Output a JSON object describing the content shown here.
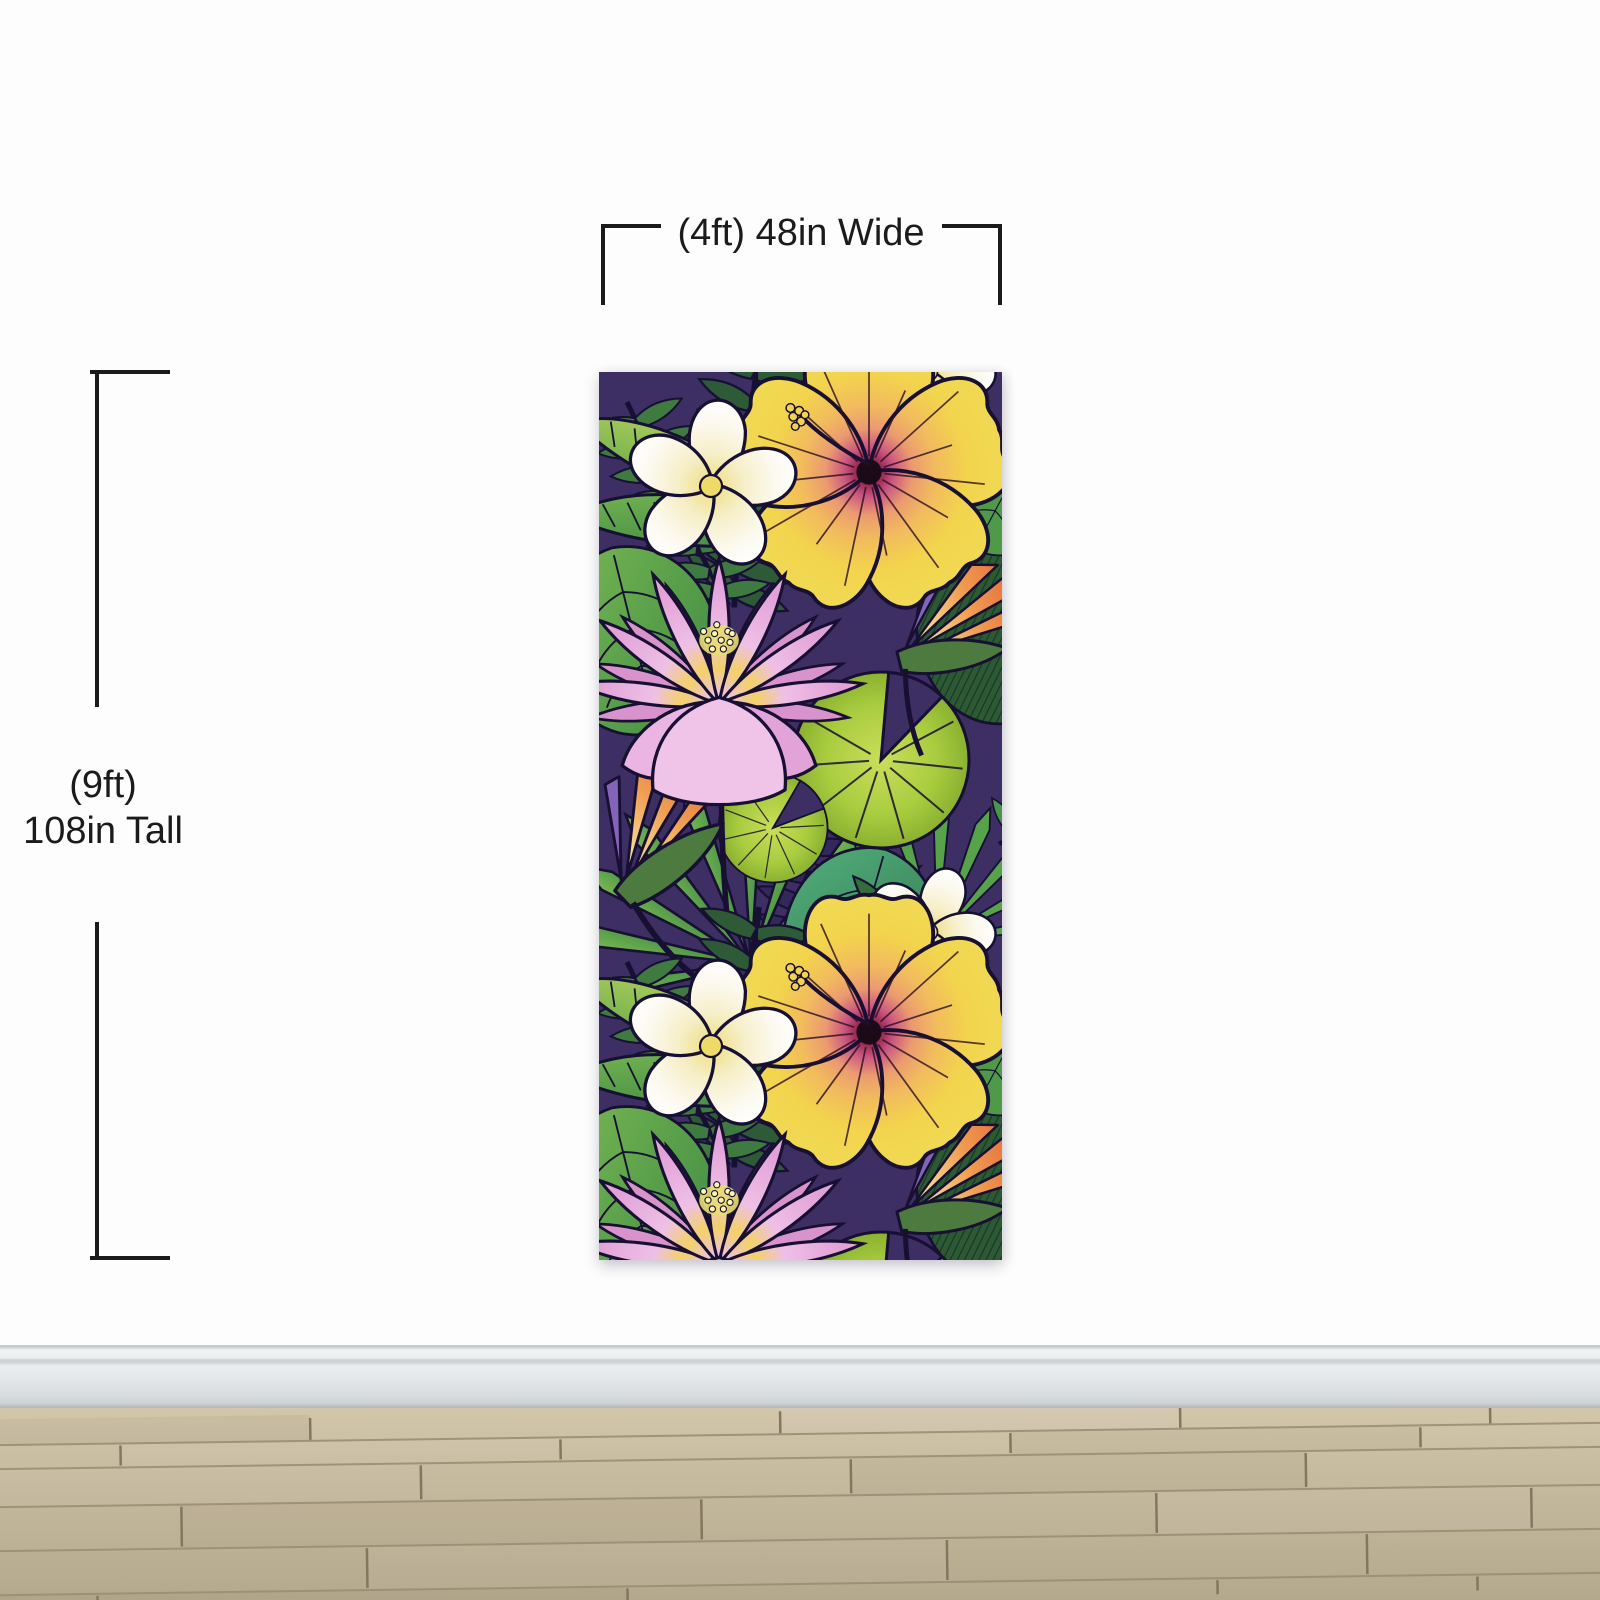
{
  "annotations": {
    "width_label": "(4ft) 48in Wide",
    "height_label": {
      "line1": "(9ft)",
      "line2": "108in Tall"
    }
  },
  "mural": {
    "type": "tropical-floral-wallpaper-panel",
    "motifs": [
      "hibiscus-flower",
      "plumeria-flower",
      "lotus-flower",
      "bird-of-paradise-flower",
      "palm-frond",
      "fan-palm-leaf",
      "monstera-leaf",
      "lily-pad"
    ],
    "palette": {
      "background_purple": "#3d2f63",
      "leaf_green": "#55a14b",
      "leaf_dark_green": "#2e5a38",
      "leaf_lime": "#a9cc3f",
      "leaf_teal": "#3f8a64",
      "hibiscus_yellow": "#f3d44d",
      "hibiscus_orange": "#eb9a70",
      "hibiscus_magenta": "#c8517f",
      "lotus_pink": "#e2a0d8",
      "plumeria_cream": "#fcf9ef",
      "plumeria_yellow": "#eedd7d",
      "bird_of_paradise_orange": "#df5a30",
      "outline_ink": "#171032"
    }
  },
  "room": {
    "wall_color": "#fdfdfd",
    "baseboard_color": "#e7ebec",
    "floor_wood_color": "#c3b79c",
    "annotation_color": "#1b1b1b"
  }
}
